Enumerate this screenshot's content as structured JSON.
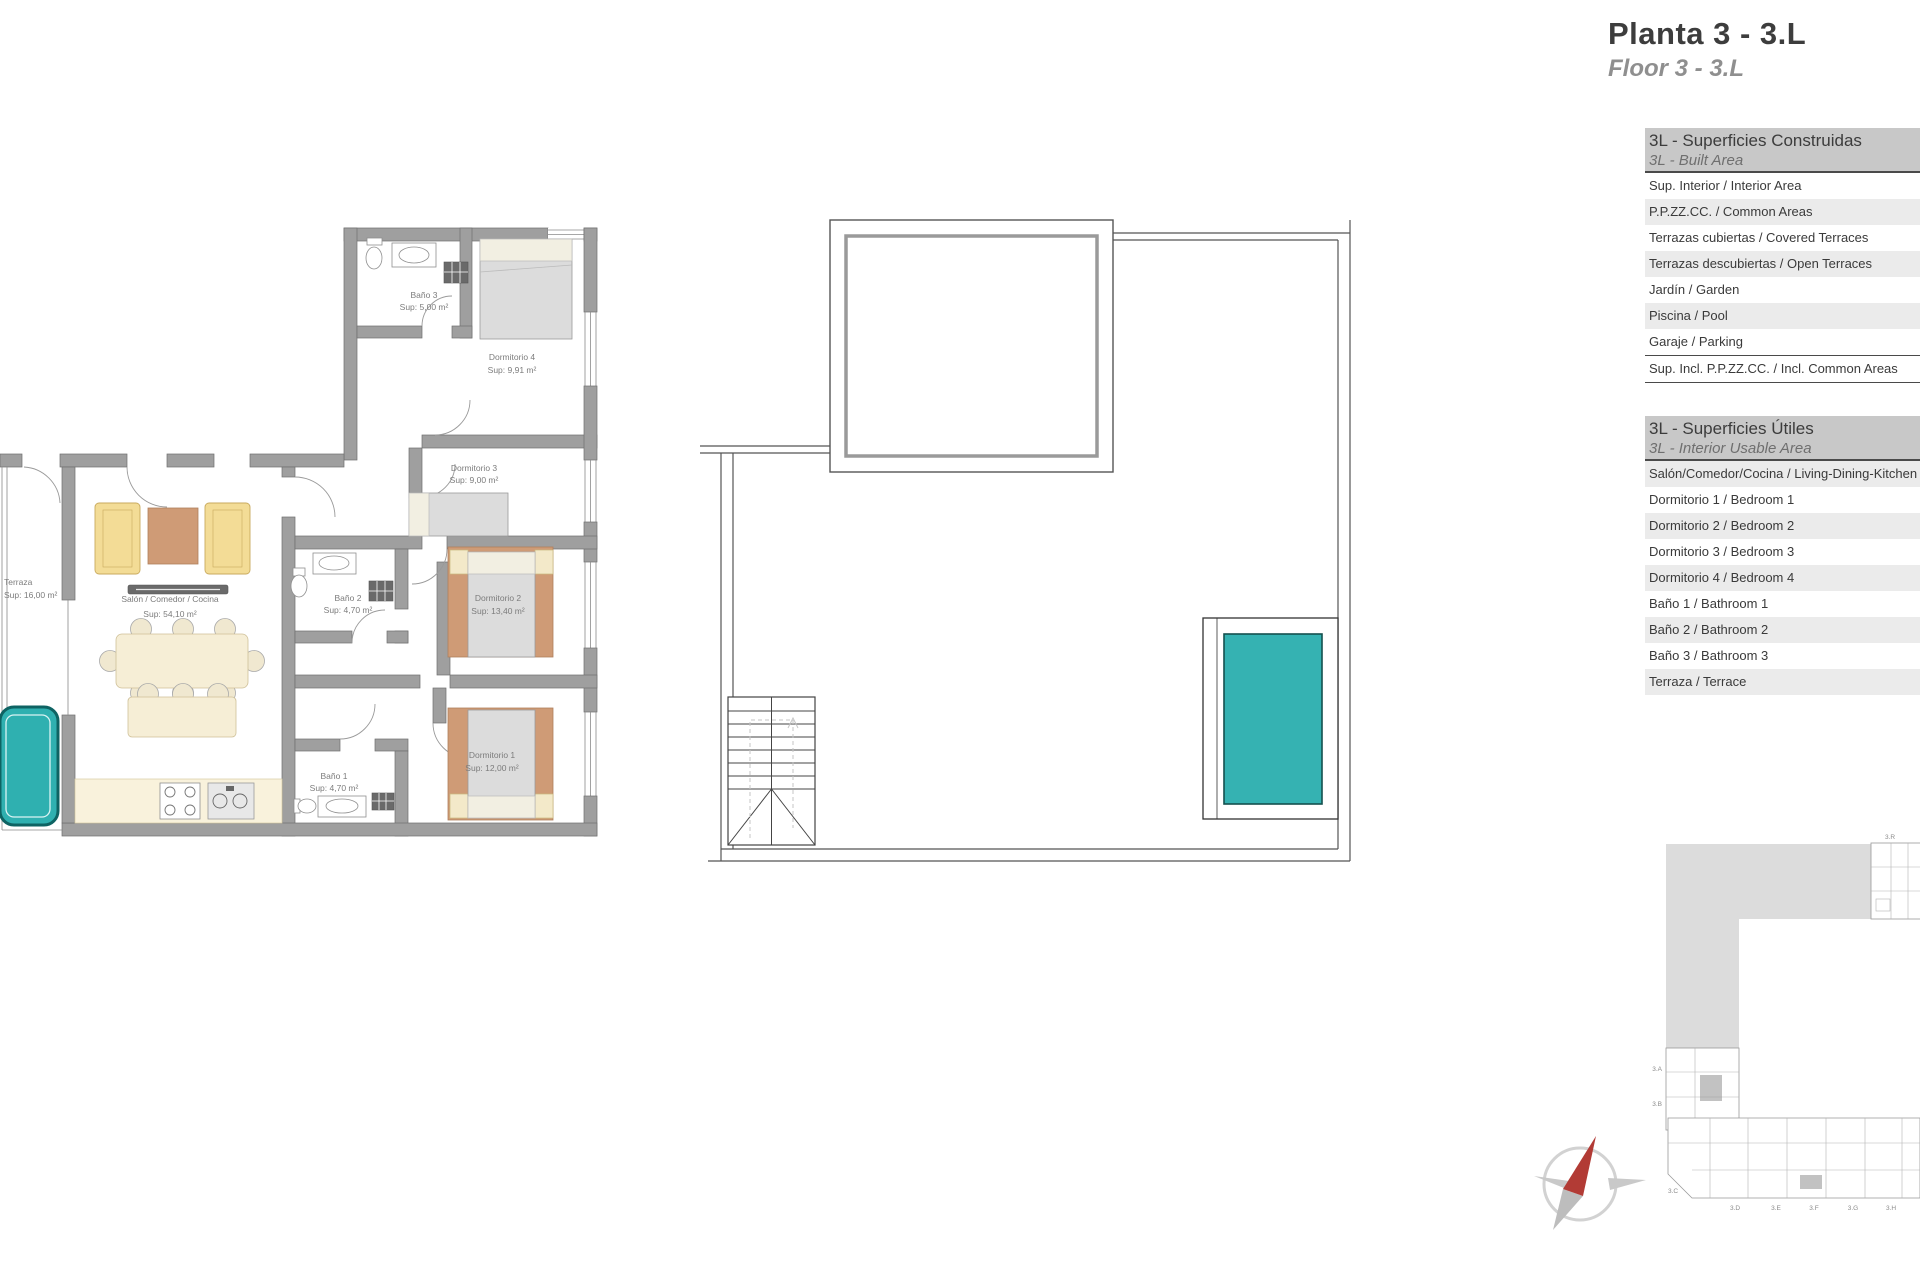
{
  "page": {
    "title_es": "Planta 3 - 3.L",
    "title_en": "Floor 3 - 3.L"
  },
  "built_table": {
    "title_es": "3L - Superficies Construidas",
    "title_en": "3L - Built Area",
    "rows": [
      "Sup. Interior / Interior Area",
      "P.P.ZZ.CC. / Common Areas",
      "Terrazas cubiertas / Covered Terraces",
      "Terrazas descubiertas / Open Terraces",
      "Jardín / Garden",
      "Piscina / Pool",
      "Garaje / Parking"
    ],
    "total": "Sup. Incl. P.P.ZZ.CC. / Incl. Common Areas"
  },
  "usable_table": {
    "title_es": "3L - Superficies Útiles",
    "title_en": "3L - Interior Usable Area",
    "rows": [
      "Salón/Comedor/Cocina / Living-Dining-Kitchen",
      "Dormitorio 1 / Bedroom 1",
      "Dormitorio 2 / Bedroom 2",
      "Dormitorio 3 / Bedroom 3",
      "Dormitorio 4 / Bedroom 4",
      "Baño 1 / Bathroom 1",
      "Baño 2 / Bathroom 2",
      "Baño 3 / Bathroom 3",
      "Terraza / Terrace"
    ]
  },
  "apartment_plan": {
    "rooms": {
      "terraza": {
        "name": "Terraza",
        "area": "Sup: 16,00 m²"
      },
      "salon": {
        "name": "Salón / Comedor / Cocina",
        "area": "Sup: 54,10 m²"
      },
      "banio1": {
        "name": "Baño 1",
        "area": "Sup: 4,70 m²"
      },
      "banio2": {
        "name": "Baño 2",
        "area": "Sup: 4,70 m²"
      },
      "banio3": {
        "name": "Baño 3",
        "area": "Sup: 5,00 m²"
      },
      "dorm1": {
        "name": "Dormitorio 1",
        "area": "Sup: 12,00 m²"
      },
      "dorm2": {
        "name": "Dormitorio 2",
        "area": "Sup: 13,40 m²"
      },
      "dorm3": {
        "name": "Dormitorio 3",
        "area": "Sup: 9,00 m²"
      },
      "dorm4": {
        "name": "Dormitorio 4",
        "area": "Sup: 9,91 m²"
      }
    }
  },
  "site_plan": {
    "labels": {
      "r": "3.R",
      "a": "3.A",
      "b": "3.B",
      "c": "3.C",
      "d": "3.D",
      "e": "3.E",
      "f": "3.F",
      "g": "3.G",
      "h": "3.H"
    }
  },
  "colors": {
    "pool_teal": "#2fb0b0",
    "wall_gray": "#9f9f9f",
    "compass_red": "#b23b35"
  }
}
